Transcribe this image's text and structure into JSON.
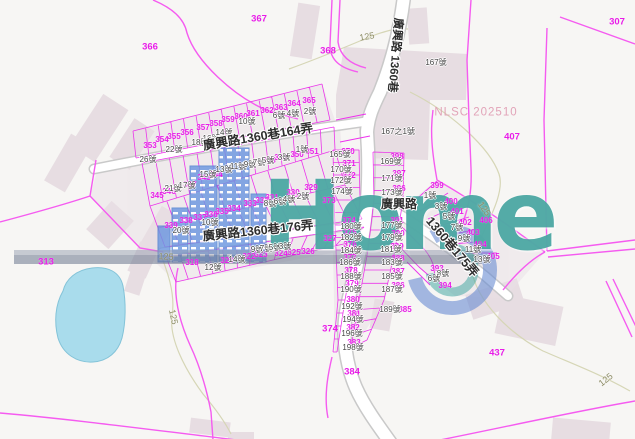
{
  "map": {
    "watermark": {
      "logo_text": "Home",
      "agency_stamp": "NLSC 202510"
    },
    "colors": {
      "parcel_text": "#e81ce8",
      "parcel_line": "#ee30ee",
      "boundary_line": "#f55bf0",
      "house_text": "#474747",
      "road_fill": "#ffffff",
      "road_casing": "#c9c9c9",
      "contour": "#d6d6b6",
      "contour_text": "#8d8d66",
      "water_fill": "#a9dcec",
      "water_edge": "#83c3d8",
      "building_fill": "#e7dde2",
      "wm_blue": "#6c97e0",
      "wm_teal": "#2d9d97"
    },
    "road_labels": [
      {
        "t": "廣興路1360巷164弄",
        "x": 258,
        "y": 137,
        "r": -9.5,
        "s": 12.5
      },
      {
        "t": "廣興路1360巷176弄",
        "x": 258,
        "y": 231,
        "r": -6,
        "s": 12.5
      },
      {
        "t": "廣興路 1360巷",
        "x": 394,
        "y": 55,
        "r": 95,
        "s": 11.5
      },
      {
        "t": "廣興路",
        "x": 399,
        "y": 204,
        "r": 0,
        "s": 12
      },
      {
        "t": "1360巷175弄",
        "x": 452,
        "y": 247,
        "r": 50,
        "s": 12.5
      }
    ],
    "contour_labels": [
      {
        "t": "125",
        "x": 367,
        "y": 37,
        "r": -10
      },
      {
        "t": "125",
        "x": 166,
        "y": 257,
        "r": 3
      },
      {
        "t": "125",
        "x": 173,
        "y": 317,
        "r": 78
      },
      {
        "t": "125",
        "x": 484,
        "y": 209,
        "r": 55
      },
      {
        "t": "125",
        "x": 606,
        "y": 380,
        "r": -38
      }
    ],
    "parcel_labels": [
      {
        "t": "366",
        "x": 150,
        "y": 47,
        "big": 1
      },
      {
        "t": "367",
        "x": 259,
        "y": 19,
        "big": 1
      },
      {
        "t": "368",
        "x": 328,
        "y": 51,
        "big": 1
      },
      {
        "t": "307",
        "x": 617,
        "y": 22,
        "big": 1
      },
      {
        "t": "313",
        "x": 46,
        "y": 262,
        "big": 1
      },
      {
        "t": "407",
        "x": 512,
        "y": 137,
        "big": 1
      },
      {
        "t": "437",
        "x": 497,
        "y": 353,
        "big": 1
      },
      {
        "t": "384",
        "x": 352,
        "y": 372,
        "big": 1
      },
      {
        "t": "374",
        "x": 330,
        "y": 329,
        "big": 1
      },
      {
        "t": "369",
        "x": 394,
        "y": 69,
        "r": 85
      },
      {
        "t": "353",
        "x": 150,
        "y": 146
      },
      {
        "t": "354",
        "x": 162,
        "y": 140
      },
      {
        "t": "355",
        "x": 174,
        "y": 137
      },
      {
        "t": "356",
        "x": 187,
        "y": 133
      },
      {
        "t": "357",
        "x": 203,
        "y": 128
      },
      {
        "t": "358",
        "x": 216,
        "y": 124
      },
      {
        "t": "359",
        "x": 228,
        "y": 120
      },
      {
        "t": "360",
        "x": 241,
        "y": 117
      },
      {
        "t": "361",
        "x": 253,
        "y": 114
      },
      {
        "t": "362",
        "x": 267,
        "y": 111
      },
      {
        "t": "363",
        "x": 281,
        "y": 108
      },
      {
        "t": "364",
        "x": 294,
        "y": 104
      },
      {
        "t": "365",
        "x": 309,
        "y": 101
      },
      {
        "t": "343",
        "x": 204,
        "y": 178
      },
      {
        "t": "344",
        "x": 216,
        "y": 175
      },
      {
        "t": "345",
        "x": 157,
        "y": 196
      },
      {
        "t": "346",
        "x": 169,
        "y": 192
      },
      {
        "t": "347",
        "x": 190,
        "y": 185
      },
      {
        "t": "348",
        "x": 269,
        "y": 161
      },
      {
        "t": "349",
        "x": 281,
        "y": 158
      },
      {
        "t": "350",
        "x": 297,
        "y": 155
      },
      {
        "t": "351",
        "x": 312,
        "y": 152
      },
      {
        "t": "339",
        "x": 171,
        "y": 226
      },
      {
        "t": "338",
        "x": 186,
        "y": 221
      },
      {
        "t": "337",
        "x": 200,
        "y": 218
      },
      {
        "t": "336",
        "x": 211,
        "y": 215
      },
      {
        "t": "335",
        "x": 222,
        "y": 212
      },
      {
        "t": "334",
        "x": 234,
        "y": 209
      },
      {
        "t": "333",
        "x": 250,
        "y": 204
      },
      {
        "t": "332",
        "x": 262,
        "y": 201
      },
      {
        "t": "331",
        "x": 272,
        "y": 198
      },
      {
        "t": "330",
        "x": 293,
        "y": 193
      },
      {
        "t": "329",
        "x": 311,
        "y": 188
      },
      {
        "t": "318",
        "x": 192,
        "y": 263
      },
      {
        "t": "320",
        "x": 227,
        "y": 261
      },
      {
        "t": "322",
        "x": 249,
        "y": 257
      },
      {
        "t": "323",
        "x": 261,
        "y": 255
      },
      {
        "t": "324",
        "x": 281,
        "y": 254
      },
      {
        "t": "325",
        "x": 294,
        "y": 253
      },
      {
        "t": "326",
        "x": 308,
        "y": 252
      },
      {
        "t": "327",
        "x": 330,
        "y": 239
      },
      {
        "t": "370",
        "x": 348,
        "y": 152
      },
      {
        "t": "371",
        "x": 349,
        "y": 164
      },
      {
        "t": "372",
        "x": 349,
        "y": 176
      },
      {
        "t": "373",
        "x": 329,
        "y": 201
      },
      {
        "t": "374",
        "x": 349,
        "y": 221
      },
      {
        "t": "375",
        "x": 350,
        "y": 233
      },
      {
        "t": "376",
        "x": 350,
        "y": 245
      },
      {
        "t": "377",
        "x": 350,
        "y": 258
      },
      {
        "t": "378",
        "x": 351,
        "y": 271
      },
      {
        "t": "379",
        "x": 352,
        "y": 284
      },
      {
        "t": "380",
        "x": 353,
        "y": 300
      },
      {
        "t": "381",
        "x": 354,
        "y": 314
      },
      {
        "t": "382",
        "x": 353,
        "y": 328
      },
      {
        "t": "383",
        "x": 354,
        "y": 343
      },
      {
        "t": "385",
        "x": 405,
        "y": 310
      },
      {
        "t": "386",
        "x": 398,
        "y": 286
      },
      {
        "t": "387",
        "x": 398,
        "y": 272
      },
      {
        "t": "388",
        "x": 398,
        "y": 259
      },
      {
        "t": "389",
        "x": 397,
        "y": 247
      },
      {
        "t": "390",
        "x": 398,
        "y": 234
      },
      {
        "t": "391",
        "x": 397,
        "y": 221
      },
      {
        "t": "396",
        "x": 399,
        "y": 189
      },
      {
        "t": "397",
        "x": 399,
        "y": 174
      },
      {
        "t": "398",
        "x": 397,
        "y": 157
      },
      {
        "t": "399",
        "x": 437,
        "y": 186
      },
      {
        "t": "400",
        "x": 451,
        "y": 202
      },
      {
        "t": "401",
        "x": 457,
        "y": 212
      },
      {
        "t": "402",
        "x": 465,
        "y": 223
      },
      {
        "t": "403",
        "x": 473,
        "y": 233
      },
      {
        "t": "404",
        "x": 480,
        "y": 245
      },
      {
        "t": "405",
        "x": 493,
        "y": 257
      },
      {
        "t": "406",
        "x": 486,
        "y": 221
      },
      {
        "t": "393",
        "x": 437,
        "y": 269
      },
      {
        "t": "394",
        "x": 445,
        "y": 286
      }
    ],
    "house_labels": [
      {
        "t": "26號",
        "x": 148,
        "y": 160
      },
      {
        "t": "22號",
        "x": 174,
        "y": 150
      },
      {
        "t": "18號",
        "x": 200,
        "y": 143
      },
      {
        "t": "16號",
        "x": 211,
        "y": 139
      },
      {
        "t": "14號",
        "x": 224,
        "y": 133
      },
      {
        "t": "10號",
        "x": 247,
        "y": 122
      },
      {
        "t": "6號",
        "x": 279,
        "y": 116
      },
      {
        "t": "4號",
        "x": 293,
        "y": 114
      },
      {
        "t": "2號",
        "x": 310,
        "y": 112
      },
      {
        "t": "21號",
        "x": 173,
        "y": 189
      },
      {
        "t": "17號",
        "x": 187,
        "y": 186
      },
      {
        "t": "15號",
        "x": 208,
        "y": 175
      },
      {
        "t": "13號",
        "x": 224,
        "y": 170
      },
      {
        "t": "11號",
        "x": 238,
        "y": 167
      },
      {
        "t": "9號",
        "x": 250,
        "y": 165
      },
      {
        "t": "7號",
        "x": 259,
        "y": 163
      },
      {
        "t": "5號",
        "x": 268,
        "y": 161
      },
      {
        "t": "3號",
        "x": 284,
        "y": 158
      },
      {
        "t": "1號",
        "x": 302,
        "y": 150
      },
      {
        "t": "20號",
        "x": 181,
        "y": 231
      },
      {
        "t": "10號",
        "x": 210,
        "y": 223
      },
      {
        "t": "8號",
        "x": 270,
        "y": 204
      },
      {
        "t": "6號",
        "x": 280,
        "y": 202
      },
      {
        "t": "4號",
        "x": 289,
        "y": 200
      },
      {
        "t": "2號",
        "x": 303,
        "y": 197
      },
      {
        "t": "12號",
        "x": 213,
        "y": 268
      },
      {
        "t": "14號",
        "x": 237,
        "y": 260
      },
      {
        "t": "9號",
        "x": 257,
        "y": 250
      },
      {
        "t": "7號",
        "x": 266,
        "y": 249
      },
      {
        "t": "5號",
        "x": 275,
        "y": 248
      },
      {
        "t": "3號",
        "x": 285,
        "y": 247
      },
      {
        "t": "167號",
        "x": 436,
        "y": 63
      },
      {
        "t": "167之1號",
        "x": 398,
        "y": 132
      },
      {
        "t": "165號",
        "x": 340,
        "y": 155
      },
      {
        "t": "170號",
        "x": 341,
        "y": 170
      },
      {
        "t": "172號",
        "x": 341,
        "y": 181
      },
      {
        "t": "174號",
        "x": 342,
        "y": 192
      },
      {
        "t": "180號",
        "x": 351,
        "y": 227
      },
      {
        "t": "182號",
        "x": 351,
        "y": 238
      },
      {
        "t": "184號",
        "x": 351,
        "y": 251
      },
      {
        "t": "186號",
        "x": 350,
        "y": 263
      },
      {
        "t": "188號",
        "x": 351,
        "y": 277
      },
      {
        "t": "190號",
        "x": 351,
        "y": 290
      },
      {
        "t": "192號",
        "x": 352,
        "y": 307
      },
      {
        "t": "194號",
        "x": 353,
        "y": 320
      },
      {
        "t": "196號",
        "x": 352,
        "y": 334
      },
      {
        "t": "198號",
        "x": 353,
        "y": 348
      },
      {
        "t": "169號",
        "x": 391,
        "y": 162
      },
      {
        "t": "171號",
        "x": 392,
        "y": 179
      },
      {
        "t": "173號",
        "x": 392,
        "y": 193
      },
      {
        "t": "177號",
        "x": 392,
        "y": 226
      },
      {
        "t": "179號",
        "x": 392,
        "y": 238
      },
      {
        "t": "181號",
        "x": 391,
        "y": 250
      },
      {
        "t": "183號",
        "x": 392,
        "y": 263
      },
      {
        "t": "185號",
        "x": 392,
        "y": 277
      },
      {
        "t": "187號",
        "x": 392,
        "y": 290
      },
      {
        "t": "189號",
        "x": 390,
        "y": 310
      },
      {
        "t": "1號",
        "x": 430,
        "y": 196
      },
      {
        "t": "3號",
        "x": 441,
        "y": 207
      },
      {
        "t": "5號",
        "x": 449,
        "y": 217
      },
      {
        "t": "7號",
        "x": 457,
        "y": 228
      },
      {
        "t": "9號",
        "x": 464,
        "y": 239
      },
      {
        "t": "11號",
        "x": 473,
        "y": 250
      },
      {
        "t": "13號",
        "x": 482,
        "y": 260
      },
      {
        "t": "8號",
        "x": 443,
        "y": 274
      },
      {
        "t": "6號",
        "x": 434,
        "y": 279
      }
    ]
  }
}
